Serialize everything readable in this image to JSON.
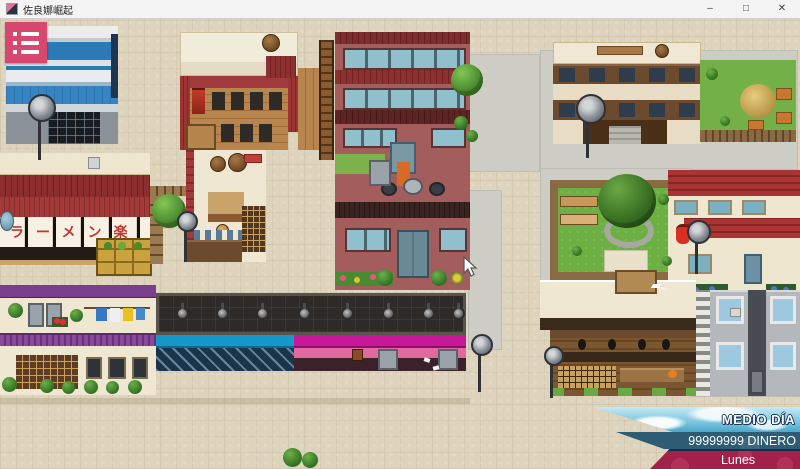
{
  "window": {
    "title": "佐良娜崛起",
    "controls": {
      "minimize": "–",
      "maximize": "□",
      "close": "✕"
    }
  },
  "menu": {
    "icon": "menu-list-icon"
  },
  "map": {
    "ramen_noren_text": "ラーメン楽"
  },
  "hud": {
    "time_of_day": "MEDIO DÍA",
    "money": "99999999 DINERO",
    "weekday": "Lunes"
  },
  "colors": {
    "menu_button": "#d8486e",
    "money_banner": "#2e5c74",
    "day_banner": "#a12148",
    "divider_navy": "#1c2c4e",
    "pavement": "#ded3bc"
  }
}
